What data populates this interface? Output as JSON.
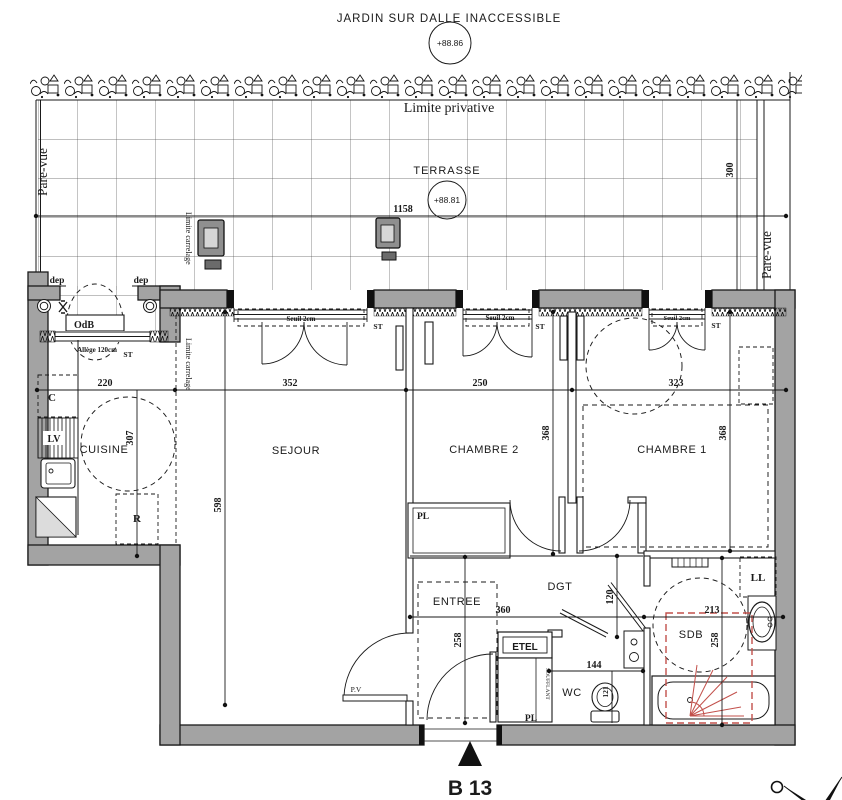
{
  "header": {
    "garden_title": "JARDIN SUR DALLE INACCESSIBLE",
    "garden_level": "+88.86",
    "limite_privative": "Limite privative",
    "terrace_label": "TERRASSE",
    "terrace_level": "+88.81",
    "plan_number": "B 13"
  },
  "rooms": {
    "cuisine": "CUISINE",
    "sejour": "SEJOUR",
    "chambre2": "CHAMBRE 2",
    "chambre1": "CHAMBRE 1",
    "entree": "ENTREE",
    "dgt": "DGT",
    "sdb": "SDB",
    "wc": "WC"
  },
  "labels": {
    "pare_vue": "Pare-vue",
    "limite_carrelage": "Limite carrelage",
    "dep": "dep",
    "odb": "OdB",
    "allege": "Allège 120cm",
    "st": "ST",
    "seuil": "Seuil 2cm",
    "pv": "P.V",
    "pl": "PL",
    "etel": "ETEL",
    "soufflant": "SOUFFLANT",
    "ll": "LL",
    "cupboard": "C",
    "dishwasher": "LV",
    "fridge": "R"
  },
  "dims": {
    "terrace_width": "1158",
    "terrace_depth": "300",
    "cuisine_width": "220",
    "sejour_width": "352",
    "chambre2_width": "250",
    "chambre1_width": "323",
    "cuisine_depth": "307",
    "sejour_depth": "598",
    "chambre2_depth": "368",
    "chambre1_depth": "368",
    "hall_width": "360",
    "sdb_width": "213",
    "entree_depth": "258",
    "sdb_depth": "258",
    "dgt_offset": "120",
    "wc_width": "144",
    "wc_offset": "121"
  },
  "colors": {
    "wall_fill": "#a3a3a3",
    "line": "#1a1a1a",
    "accent_red": "#c2504b",
    "tile_line": "#555555"
  }
}
